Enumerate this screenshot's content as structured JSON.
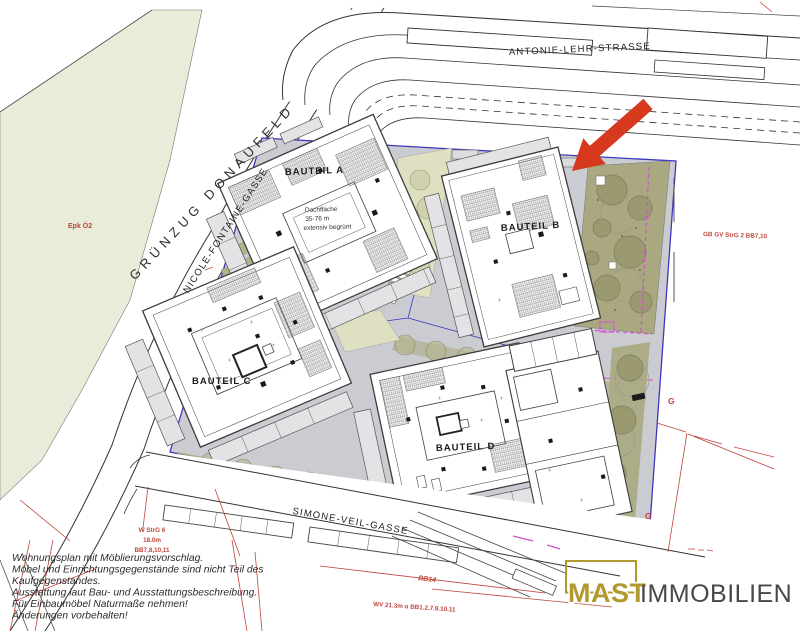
{
  "title": "Lageplan Wohnprojekt Donaufeld",
  "colors": {
    "field_green": "#e9ecd8",
    "plot_gray": "#cbccd2",
    "park_olive": "#a9a880",
    "light_green": "#dfe0c2",
    "tree_olive": "#9a9970",
    "building_stroke": "#3c3c3c",
    "building_gray": "#e3e3e5",
    "boundary_blue": "#3c38bf",
    "magenta": "#d44fd0",
    "arrow_red": "#d6391d",
    "annotation_red": "#c0443b",
    "logo_gold": "#b1992f",
    "logo_gray": "#46474b"
  },
  "streets": {
    "antonie": "ANTONIE-LEHR-STRASSE",
    "nicole": "NICOLE-FONTAINE-GASSE",
    "simone": "SIMONE-VEIL-GASSE",
    "gruenzug": "GRÜNZUG DONAUFELD"
  },
  "buildings": {
    "a": {
      "label": "BAUTEIL A",
      "note_line1": "Dachfläche",
      "note_line2": "35-76 m",
      "note_line3": "extensiv begrünt"
    },
    "b": {
      "label": "BAUTEIL B"
    },
    "c": {
      "label": "BAUTEIL C"
    },
    "d": {
      "label": "BAUTEIL D"
    }
  },
  "annotations": {
    "epk": "Epk Ö2",
    "w_strg": "W StrG 6",
    "w_strg_height": "18.0m",
    "w_strg_bb": "BB7,8,10,11",
    "bb14": "BB14",
    "wv": "WV 21.3m o BB1.2.7.9.10.11",
    "gb_gv": "GB GV StrG 2 BB7,10",
    "g_upper": "G",
    "g_lower": "G"
  },
  "notes": {
    "line1": "Wohnungsplan mit Möblierungsvorschlag.",
    "line2": "Möbel und Einrichtungsgegenstände sind nicht Teil des",
    "line3": "Kaufgegenstandes.",
    "line4": "Ausstattung laut Bau- und Ausstattungsbeschreibung.",
    "line5": "Für Einbaumöbel Naturmaße nehmen!",
    "line6": "Änderungen vorbehalten!"
  },
  "logo": {
    "name": "MAST",
    "suffix": "IMMOBILIEN"
  }
}
